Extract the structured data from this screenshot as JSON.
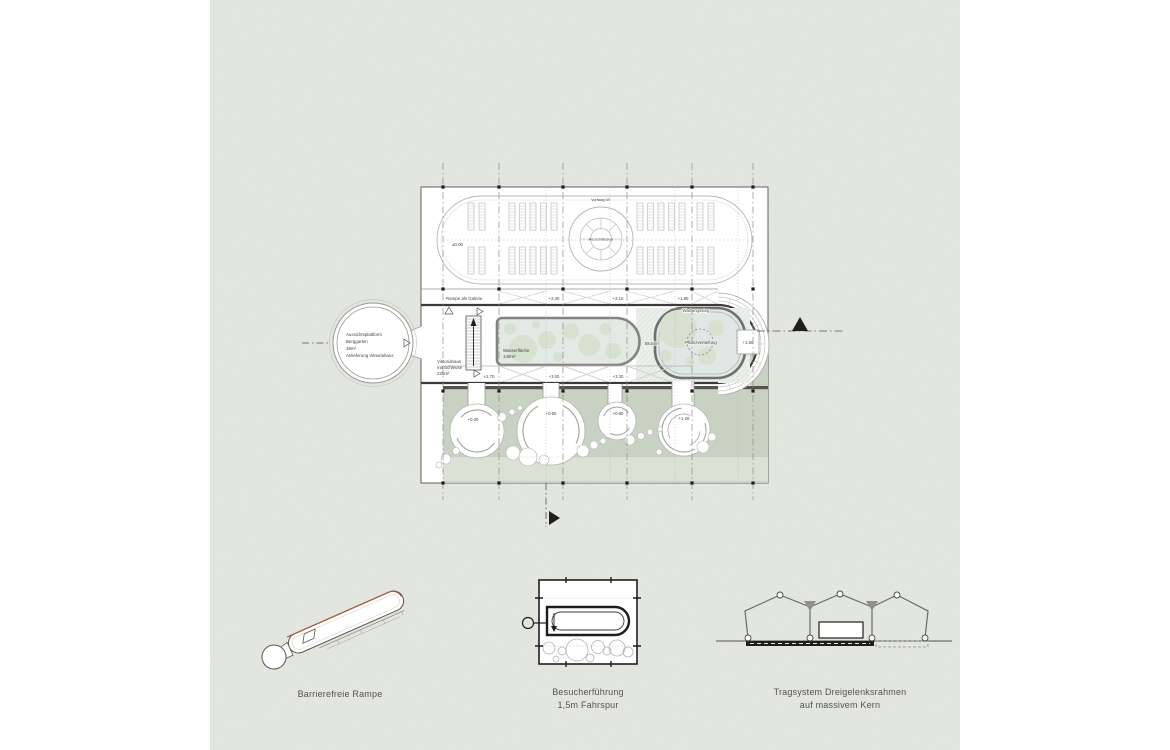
{
  "colors": {
    "paper": "#e5e8e1",
    "plan_white": "#ffffff",
    "green_band": "#c8d2c2",
    "green_light_strip": "#dbe1d5",
    "plant_green": "#d6e1ce",
    "water": "#e3eae6",
    "line_dark": "#3a3a38",
    "line_mid": "#8f8f8b",
    "ramp_accent_red": "#a8573f",
    "ink_black": "#1e1e1c"
  },
  "plan": {
    "labels": {
      "level_zero": "±0.00",
      "vorhang_uk": "Vorhang UK",
      "anzuchtbecken": "Anzuchtbecken",
      "rampe_galerie": "Rampe als Galerie",
      "l240": "+2.40",
      "l210": "+2.10",
      "l180": "+1.80",
      "wartungssteg": "Wartungssteg",
      "bruecke": "Brücke",
      "pflanzvertiefung": "Pflanzvertiefung",
      "l150": "+1.50",
      "wasser1": "Wasserfläche",
      "wasser2": "140m²",
      "vik1": "Viktoriahaus",
      "vik2": "mit Schleuse",
      "vik3": "225m²",
      "l270": "+2.70",
      "l300": "+3.00",
      "l330": "+3.30",
      "g030": "+0.30",
      "g060": "+0.60",
      "g090": "+0.90",
      "g120": "+1.20"
    },
    "bubble": {
      "l1": "Aussichtsplattform",
      "l2": "Berggarten",
      "l3": "38m²",
      "l4": "Anlieferung Viktoriahaus"
    }
  },
  "diagrams": {
    "ramp": {
      "caption": "Barrierefreie Rampe"
    },
    "visitor": {
      "caption_line1": "Besucherführung",
      "caption_line2": "1,5m Fahrspur"
    },
    "structure": {
      "caption_line1": "Tragsystem Dreigelenksrahmen",
      "caption_line2": "auf massivem Kern"
    }
  },
  "icons": {
    "north_arrow": "filled-triangle-up",
    "entrance_arrow": "filled-triangle-right",
    "stair_direction_arrow": "filled-triangle-up",
    "door_symbols": "outline-triangles"
  }
}
